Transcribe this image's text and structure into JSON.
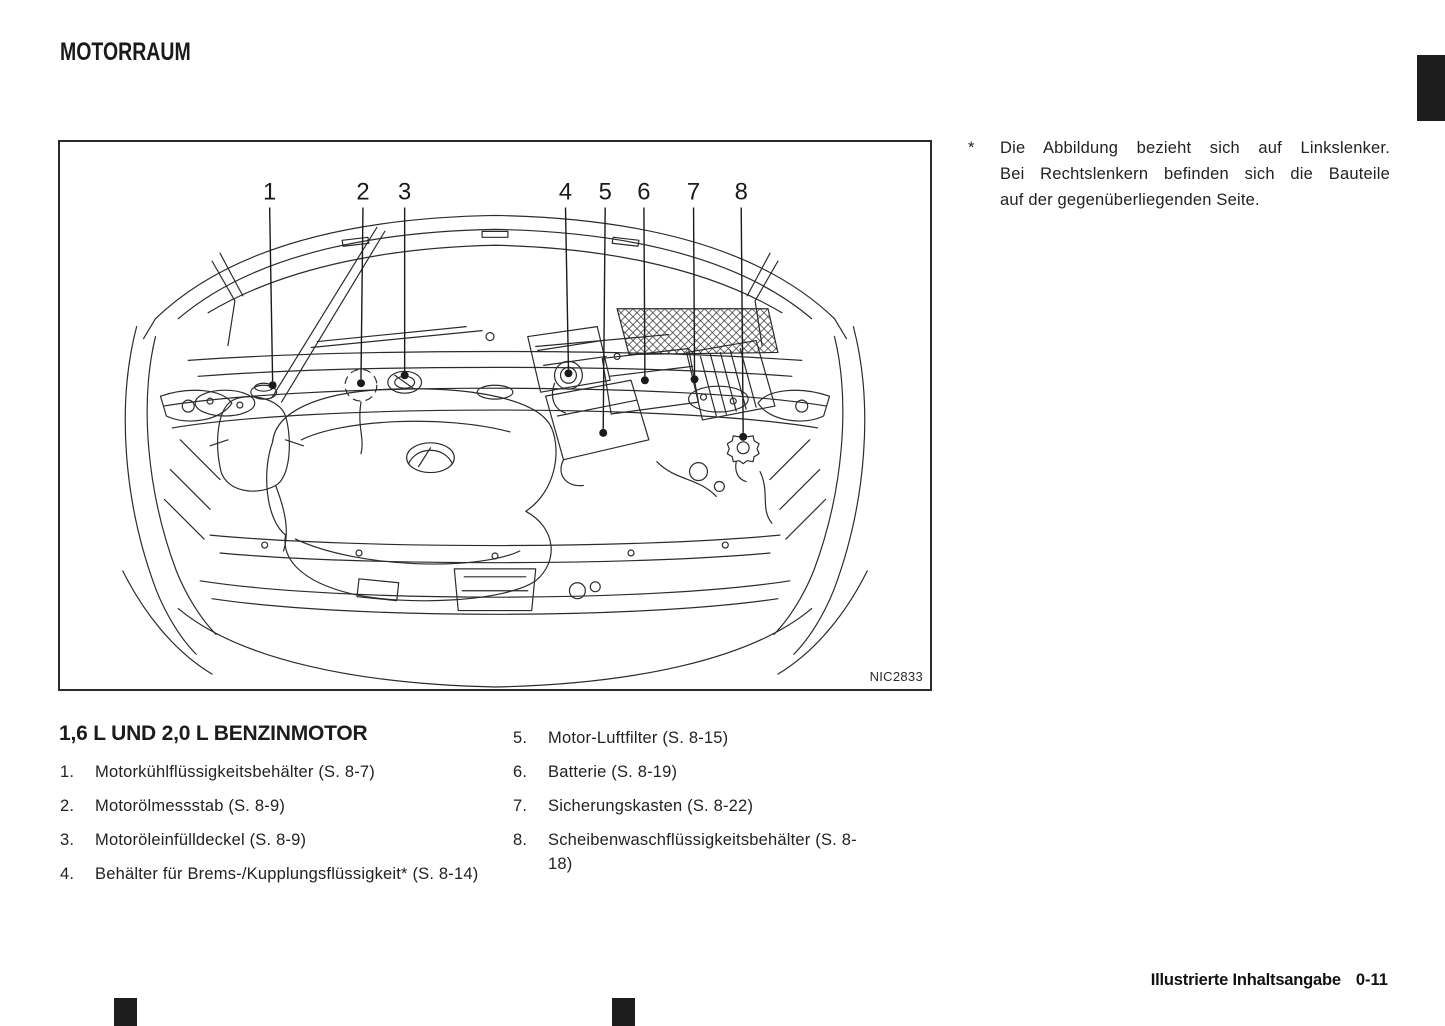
{
  "page": {
    "title": "MOTORRAUM",
    "footer_label": "Illustrierte Inhaltsangabe",
    "footer_page": "0-11"
  },
  "figure": {
    "code": "NIC2833",
    "callout_labels": [
      "1",
      "2",
      "3",
      "4",
      "5",
      "6",
      "7",
      "8"
    ]
  },
  "note": {
    "marker": "*",
    "lines": [
      "Die Abbildung bezieht sich auf Linkslenker.",
      "Bei Rechtslenkern befinden sich die Bauteile",
      "auf der gegenüberliegenden Seite."
    ]
  },
  "legend": {
    "heading": "1,6 L UND 2,0 L BENZINMOTOR",
    "items_left": [
      {
        "num": "1.",
        "text": "Motorkühlflüssigkeitsbehälter (S. 8-7)"
      },
      {
        "num": "2.",
        "text": "Motorölmessstab (S. 8-9)"
      },
      {
        "num": "3.",
        "text": "Motoröleinfülldeckel (S. 8-9)"
      },
      {
        "num": "4.",
        "text": "Behälter für Brems-/Kupplungsflüssigkeit* (S. 8-14)"
      }
    ],
    "items_right": [
      {
        "num": "5.",
        "text": "Motor-Luftfilter (S. 8-15)"
      },
      {
        "num": "6.",
        "text": "Batterie (S. 8-19)"
      },
      {
        "num": "7.",
        "text": "Sicherungskasten (S. 8-22)"
      },
      {
        "num": "8.",
        "text": "Scheibenwaschflüssigkeitsbehälter (S. 8-18)"
      }
    ]
  },
  "colors": {
    "ink": "#1a1a1a",
    "line": "#2b2b2b",
    "background": "#ffffff"
  }
}
